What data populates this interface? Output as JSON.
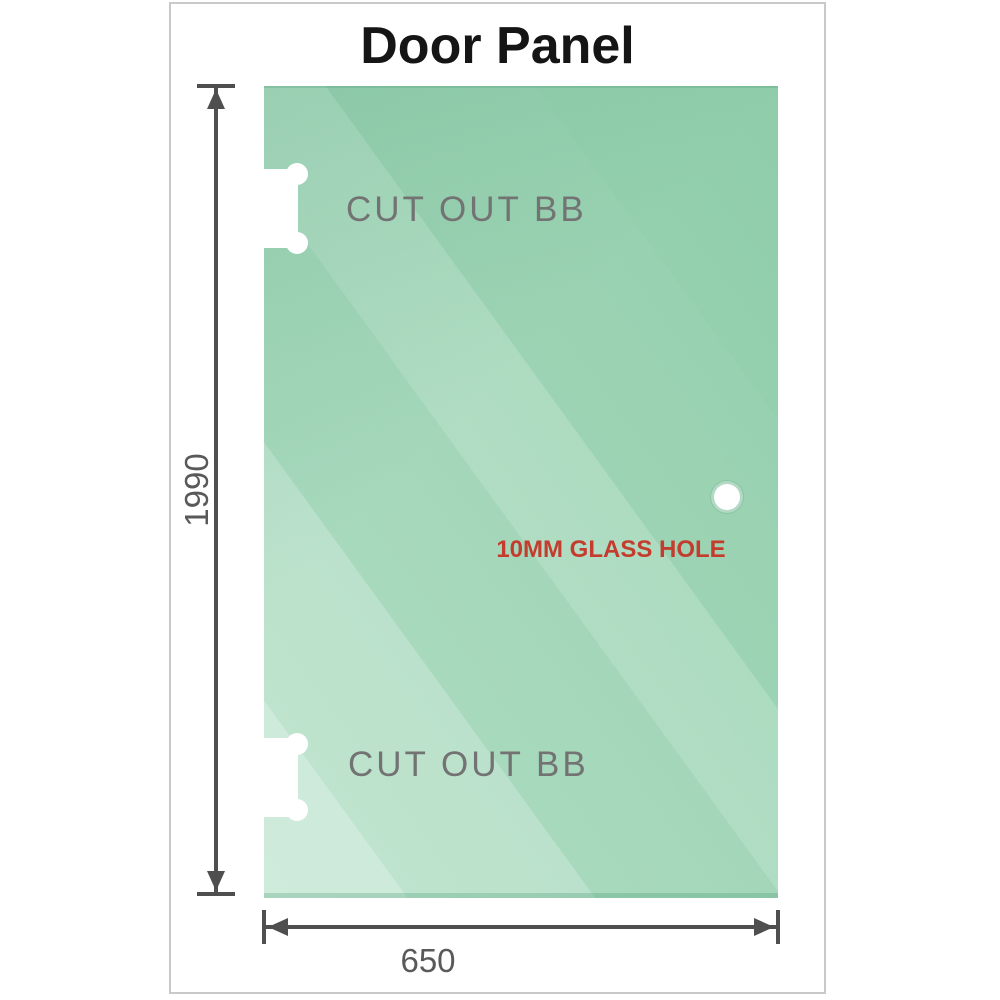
{
  "title": "Door Panel",
  "panel": {
    "cutout_top_label": "CUT OUT BB",
    "cutout_bottom_label": "CUT OUT BB",
    "hole_label": "10MM GLASS HOLE"
  },
  "dimensions": {
    "height_label": "1990",
    "width_label": "650"
  },
  "colors": {
    "glass_base": "#a8dabd",
    "glass_dark": "#8fcdaa",
    "glass_light": "#cdecd8",
    "cutout_fill": "#ffffff",
    "dimension_line": "#4f4f4f",
    "dimension_text": "#595959",
    "cutout_text": "#737373",
    "hole_text": "#c43c2e",
    "title_text": "#151515",
    "frame_border": "#c9c9c9"
  }
}
